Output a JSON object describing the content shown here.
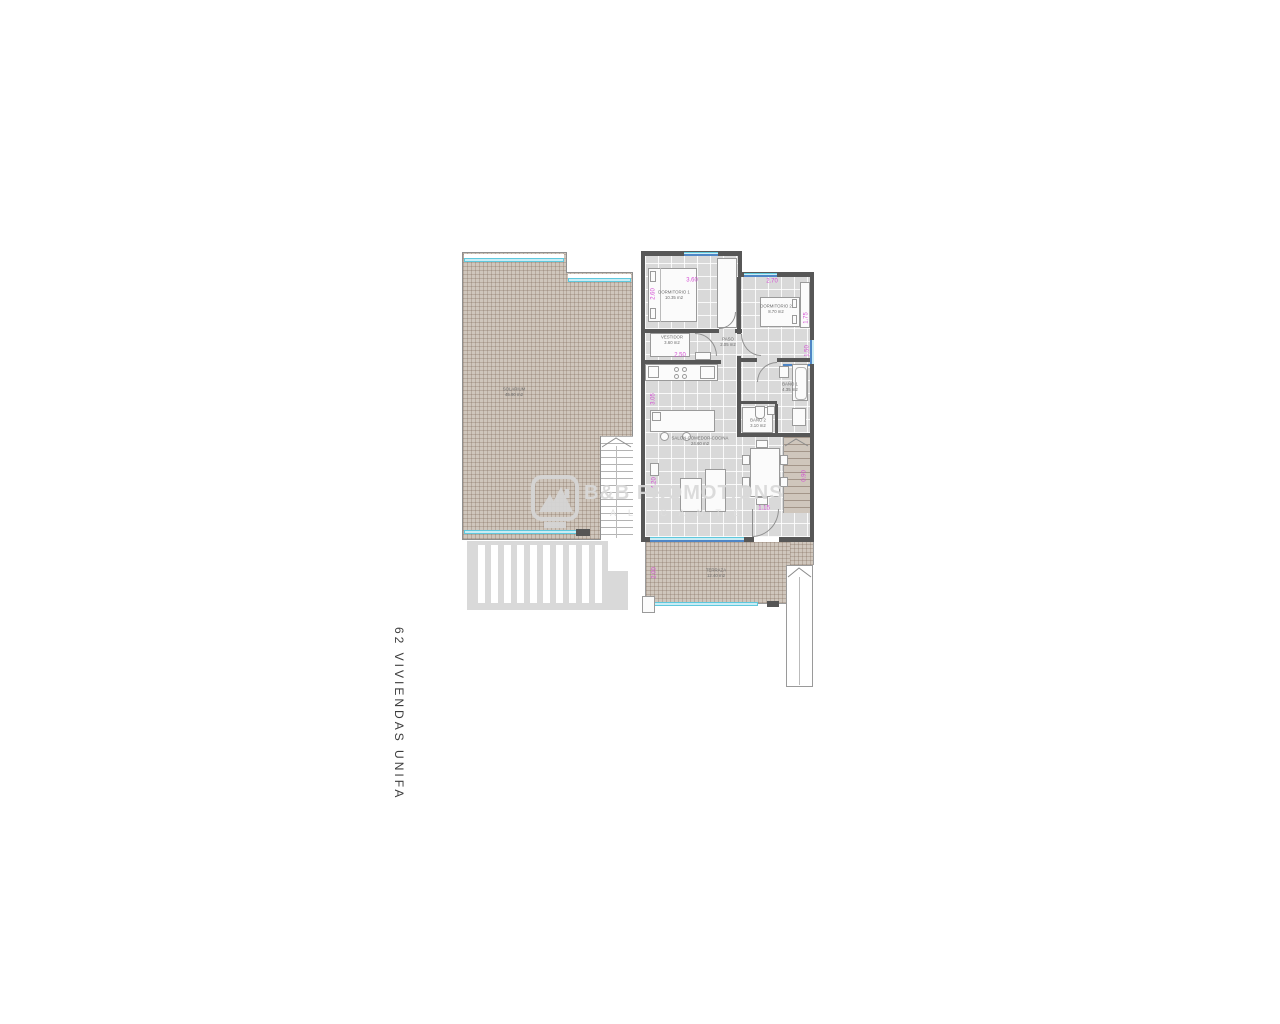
{
  "title": {
    "vertical_label": "62 VIVIENDAS UNIFA"
  },
  "watermark": {
    "brand": "B&B PROMOTIONS",
    "subtitle": "A L I C A N T E"
  },
  "left_plan": {
    "solarium": {
      "name": "SOLARIUM",
      "area": "45.90 m2"
    }
  },
  "right_plan": {
    "rooms": {
      "bedroom1": {
        "name": "DORMITORIO 1",
        "area": "10.35 m2"
      },
      "bedroom2": {
        "name": "DORMITORIO 2",
        "area": "8.70 m2"
      },
      "closet": {
        "name": "VESTIDOR",
        "area": "3.60 m2"
      },
      "hall": {
        "name": "PASO",
        "area": "2.05 m2"
      },
      "bath1": {
        "name": "BAÑO 1",
        "area": "4.35 m2"
      },
      "bath2": {
        "name": "BAÑO 2",
        "area": "3.10 m2"
      },
      "living": {
        "name": "SALON-COMEDOR-COCINA",
        "area": "24.60 m2"
      },
      "terrace": {
        "name": "TERRAZA",
        "area": "12.40 m2"
      }
    },
    "dimensions": {
      "bedroom1_width": "3.60",
      "bedroom2_width": "2.70",
      "closet_width": "2.50",
      "bedroom1_side": "2.60",
      "bedroom2_side": "1.75",
      "kitchen_side": "3.05",
      "living_side": "4.20",
      "terrace_side": "2.00",
      "door_bottom": "1.15",
      "stairs_side": "0.90",
      "bath_window": "1.50"
    }
  },
  "colors": {
    "wall": "#575757",
    "floor": "#d9d9d9",
    "terrace_hatch": "#cfc6bc",
    "glass": "#c9ecf4",
    "glass_edge": "#5fc8dd",
    "window_blue": "#4f86c6",
    "dimension_magenta": "#d44fd4",
    "watermark_gray": "#d9d9d9"
  }
}
